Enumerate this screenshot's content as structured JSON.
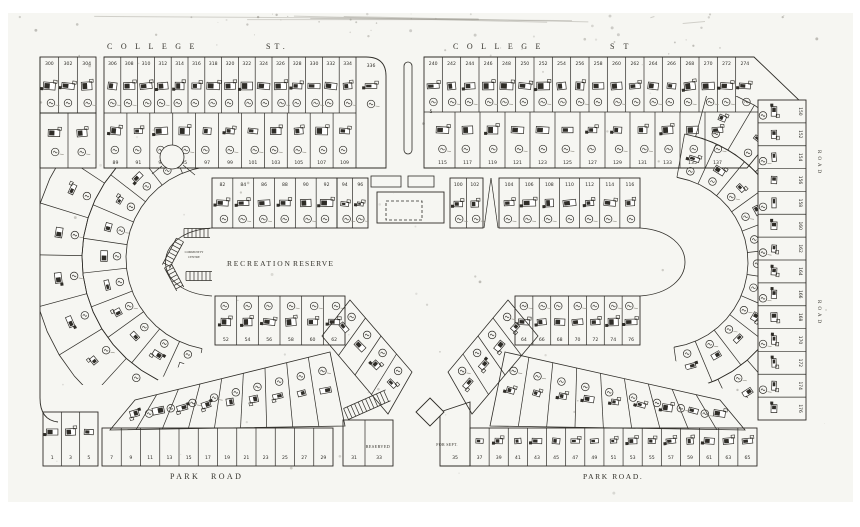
{
  "colors": {
    "paper": "#f6f6f2",
    "ink": "#2e2c27",
    "faint": "#8b887e",
    "light": "#55524b"
  },
  "streets": {
    "college": "COLLEGE",
    "st": "ST",
    "st_period": "ST.",
    "park_word1": "PARK",
    "park_word2": "ROAD",
    "park_right_full": "PARK ROAD.",
    "side_right": "ROAD"
  },
  "labels": {
    "reserve_word1": "RECREATION",
    "reserve_word2": "RESERVE",
    "reserved": "RESERVED",
    "for_sept": "FOR SEPT.",
    "community_line1": "COMMUNITY",
    "community_line2": "CENTRE"
  },
  "lot_numbers": {
    "top_left_small": [
      "300",
      "302",
      "304"
    ],
    "top_left_main": [
      "306",
      "308",
      "310",
      "312",
      "314",
      "316",
      "318",
      "320",
      "322",
      "324",
      "326",
      "328",
      "330",
      "332",
      "334"
    ],
    "top_left_end": "336",
    "top_right": [
      "240",
      "242",
      "244",
      "246",
      "248",
      "250",
      "252",
      "254",
      "256",
      "258",
      "260",
      "262",
      "264",
      "266",
      "268",
      "270",
      "272",
      "274"
    ],
    "second_row_left": [
      "89",
      "91",
      "93",
      "95",
      "97",
      "99",
      "101",
      "103",
      "105",
      "107",
      "109"
    ],
    "second_row_right": [
      "115",
      "117",
      "119",
      "121",
      "123",
      "125",
      "127",
      "129",
      "131",
      "133",
      "135",
      "137"
    ],
    "inner_north_west": [
      "82",
      "84",
      "86",
      "88",
      "90",
      "92"
    ],
    "inner_north_mid": [
      "94",
      "96"
    ],
    "inner_north_pair": [
      "100",
      "102"
    ],
    "inner_north_east": [
      "104",
      "106",
      "108",
      "110",
      "112",
      "114",
      "116"
    ],
    "inner_south_west": [
      "52",
      "54",
      "56",
      "58",
      "60",
      "62"
    ],
    "inner_south_east": [
      "64",
      "66",
      "68",
      "70",
      "72",
      "74",
      "76"
    ],
    "east_column": [
      "150",
      "152",
      "154",
      "156",
      "158",
      "160",
      "162",
      "164",
      "166",
      "168",
      "170",
      "172",
      "174",
      "176"
    ],
    "bottom_left_a": [
      "1",
      "3",
      "5"
    ],
    "bottom_left_b": [
      "7",
      "9",
      "11",
      "13",
      "15",
      "17",
      "19",
      "21",
      "23",
      "25",
      "27",
      "29"
    ],
    "bottom_left_c": [
      "31",
      "33"
    ],
    "bottom_mid": [
      "35"
    ],
    "bottom_right": [
      "37",
      "39",
      "41",
      "43",
      "45",
      "47",
      "49",
      "51",
      "53",
      "55",
      "57",
      "59",
      "61",
      "63",
      "65"
    ],
    "misc_5": "5"
  }
}
